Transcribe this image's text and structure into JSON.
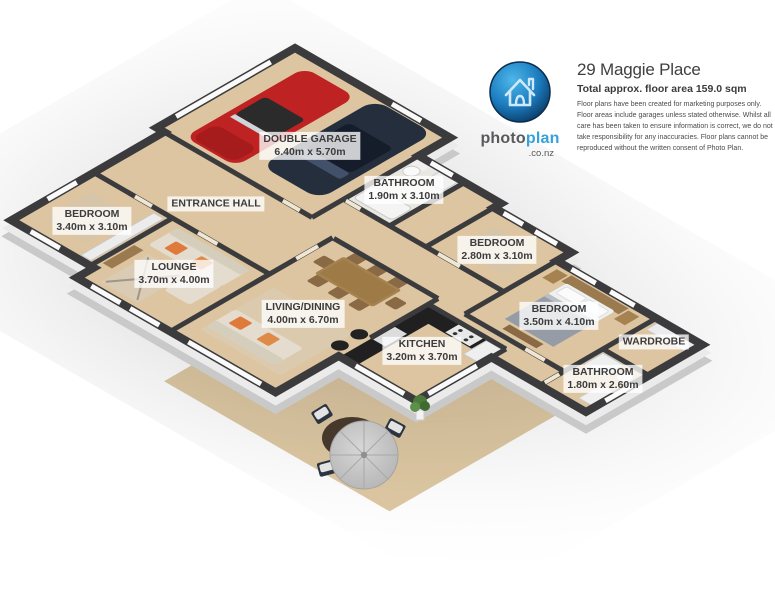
{
  "header": {
    "title": "29 Maggie Place",
    "subtitle": "Total approx. floor area 159.0 sqm",
    "disclaimer": "Floor plans have been created for marketing purposes only. Floor areas include garages unless stated otherwise. Whilst all care has been taken to ensure information is correct, we do not take responsibility for any inaccuracies. Floor plans cannot be reproduced without the written consent of Photo Plan.",
    "logo": {
      "brand_photo": "photo",
      "brand_plan": "plan",
      "brand_suffix": ".co.nz",
      "icon": "house-icon"
    }
  },
  "floorplan": {
    "labels": [
      {
        "name": "DOUBLE GARAGE",
        "dims": "6.40m x 5.70m",
        "x": 310,
        "y": 146
      },
      {
        "name": "BATHROOM",
        "dims": "1.90m x 3.10m",
        "x": 404,
        "y": 190
      },
      {
        "name": "ENTRANCE HALL",
        "dims": "",
        "x": 216,
        "y": 204
      },
      {
        "name": "BEDROOM",
        "dims": "3.40m x 3.10m",
        "x": 92,
        "y": 221
      },
      {
        "name": "BEDROOM",
        "dims": "2.80m x 3.10m",
        "x": 497,
        "y": 250
      },
      {
        "name": "LOUNGE",
        "dims": "3.70m x 4.00m",
        "x": 174,
        "y": 274
      },
      {
        "name": "LIVING/DINING",
        "dims": "4.00m x 6.70m",
        "x": 303,
        "y": 314
      },
      {
        "name": "BEDROOM",
        "dims": "3.50m x 4.10m",
        "x": 559,
        "y": 316
      },
      {
        "name": "WARDROBE",
        "dims": "",
        "x": 654,
        "y": 342
      },
      {
        "name": "KITCHEN",
        "dims": "3.20m x 3.70m",
        "x": 422,
        "y": 351
      },
      {
        "name": "BATHROOM",
        "dims": "1.80m x 2.60m",
        "x": 603,
        "y": 379
      }
    ],
    "colors": {
      "wall_top": "#3b3b3d",
      "wall_side_white": "#ebebeb",
      "wall_side_grey": "#c9c9c9",
      "floor": "#dcc5a0",
      "patio": "#dfc9a4",
      "bathroom_floor": "#e9e7e2",
      "accent_blue": "#35a2db",
      "car_red": "#bf2222",
      "car_dark": "#252e3d"
    }
  }
}
